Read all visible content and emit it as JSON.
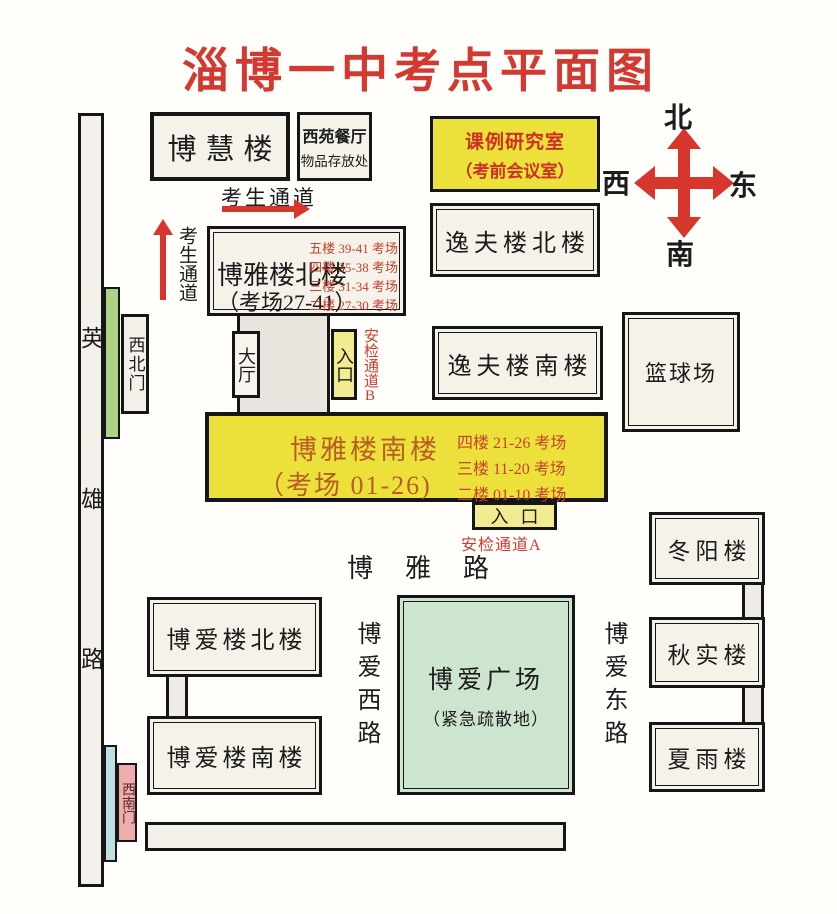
{
  "title": "淄博一中考点平面图",
  "compass": {
    "north": "北",
    "south": "南",
    "east": "东",
    "west": "西"
  },
  "roads": {
    "yingxiong": [
      "英",
      "雄",
      "路"
    ],
    "boya": "博雅路",
    "boai_west": "博爱西路",
    "boai_east": "博爱东路"
  },
  "gates": {
    "northwest": "西北门",
    "southwest": "西南门"
  },
  "buildings": {
    "bohui": "博慧楼",
    "xiyuan": {
      "name": "西苑餐厅",
      "note": "物品存放处"
    },
    "keli": {
      "line1": "课例研究室",
      "line2": "（考前会议室）"
    },
    "yifu_north": "逸夫楼北楼",
    "yifu_south": "逸夫楼南楼",
    "basketball": "篮球场",
    "hall": "大厅",
    "boya_north": {
      "name": "博雅楼北楼",
      "rooms": "（考场27-41）",
      "floors": [
        "五楼 39-41 考场",
        "四楼 35-38 考场",
        "三楼 31-34 考场",
        "二楼 27-30 考场"
      ]
    },
    "boya_south": {
      "name": "博雅楼南楼",
      "rooms": "（考场 01-26)",
      "floors": [
        "四楼 21-26 考场",
        "三楼 11-20 考场",
        "二楼 01-10 考场"
      ]
    },
    "boai_north": "博爱楼北楼",
    "boai_south": "博爱楼南楼",
    "plaza": {
      "name": "博爱广场",
      "note": "（紧急疏散地）"
    },
    "dongyang": "冬阳楼",
    "qiushi": "秋实楼",
    "xiayu": "夏雨楼"
  },
  "passages": {
    "corridor_h": "考生通道",
    "corridor_v": "考生通道",
    "entrance_a": "入口",
    "entrance_b": "入口",
    "security_a": "安检通道A",
    "security_b": "安检通道B"
  },
  "colors": {
    "accent_red": "#d23a31",
    "arrow_red": "#d6362b",
    "highlight_yellow": "#ece13a",
    "entrance_yellow": "#f1ec92",
    "plaza_green": "#cde4cf",
    "gate_green": "#aed387",
    "gate_pink": "#eeacae",
    "strip_blue": "#bfdfe3",
    "building_fill": "#f5f2ea"
  }
}
